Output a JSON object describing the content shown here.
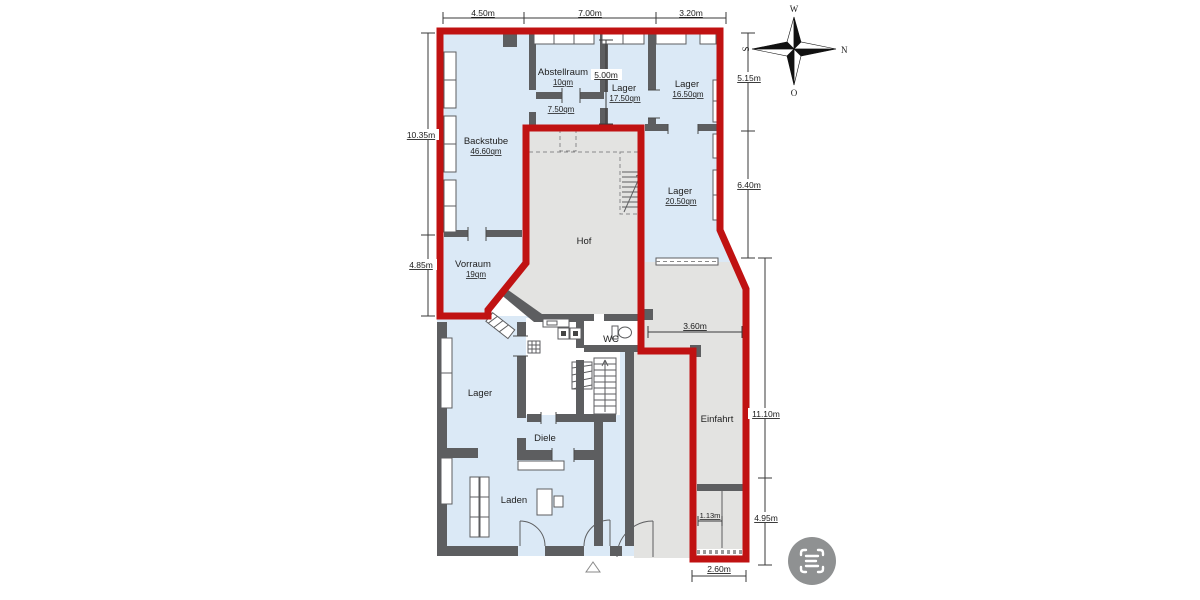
{
  "plan": {
    "title": "Grundriss Erdgeschoss",
    "rooms": {
      "abstellraum": {
        "name": "Abstellraum",
        "area": "10qm"
      },
      "room_750": {
        "area": "7.50qm"
      },
      "lager_1750": {
        "name": "Lager",
        "area": "17.50qm"
      },
      "lager_1650": {
        "name": "Lager",
        "area": "16.50qm"
      },
      "backstube": {
        "name": "Backstube",
        "area": "46.60qm"
      },
      "lager_2050": {
        "name": "Lager",
        "area": "20.50qm"
      },
      "hof": {
        "name": "Hof"
      },
      "vorraum": {
        "name": "Vorraum",
        "area": "19qm"
      },
      "wc": {
        "name": "WC"
      },
      "lager_unten": {
        "name": "Lager"
      },
      "diele": {
        "name": "Diele"
      },
      "laden": {
        "name": "Laden"
      },
      "einfahrt": {
        "name": "Einfahrt"
      }
    },
    "dimensions": {
      "top": [
        "4.50m",
        "7.00m",
        "3.20m"
      ],
      "left": [
        "10.35m",
        "4.85m"
      ],
      "right_inner": [
        "5.15m",
        "6.40m"
      ],
      "right_outer": [
        "11.10m",
        "4.95m"
      ],
      "inner_500": "5.00m",
      "inner_360": "3.60m",
      "inner_113": "1.13m",
      "bottom_260": "2.60m"
    },
    "compass": {
      "west": "W",
      "north": "N",
      "east": "O",
      "south": "S"
    },
    "colors": {
      "highlight_red": "#c01212",
      "room_fill": "#dbe9f6",
      "court_fill": "#e3e3e1",
      "wall_fill": "#5d5e60",
      "icon_bg": "#8f9192"
    },
    "scan_button": {
      "icon": "scan-icon"
    }
  }
}
